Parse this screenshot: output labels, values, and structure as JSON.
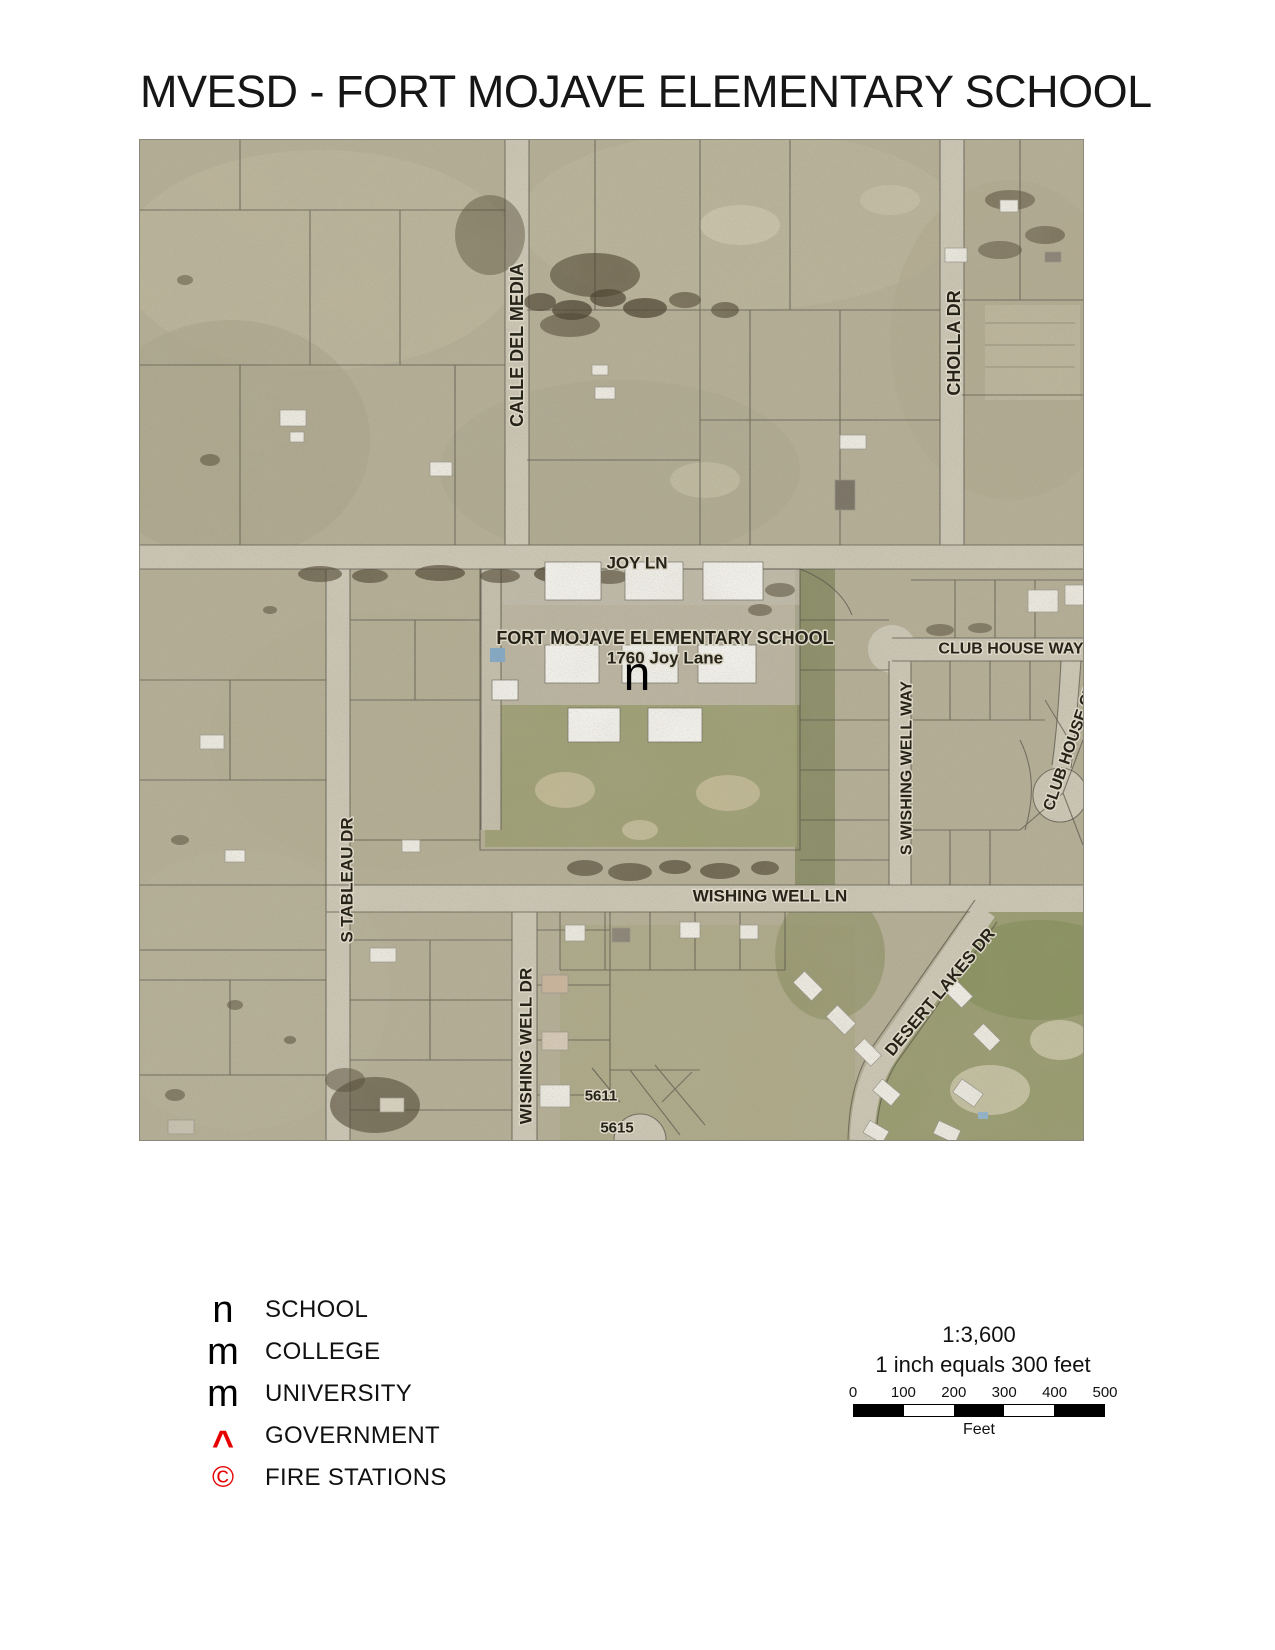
{
  "title": "MVESD - FORT MOJAVE ELEMENTARY SCHOOL",
  "map": {
    "school": {
      "name": "FORT MOJAVE ELEMENTARY SCHOOL",
      "address": "1760 Joy Lane",
      "marker": "n"
    },
    "streets": {
      "calle_del_media": "CALLE DEL MEDIA",
      "cholla_dr": "CHOLLA DR",
      "joy_ln": "JOY LN",
      "club_house_way": "CLUB HOUSE WAY",
      "s_wishing_well_way": "S WISHING WELL WAY",
      "club_house_ct": "CLUB HOUSE CT",
      "s_tableau_dr": "S TABLEAU DR",
      "wishing_well_ln": "WISHING WELL LN",
      "wishing_well_dr": "WISHING WELL DR",
      "desert_lakes_dr": "DESERT LAKES DR"
    },
    "parcel_numbers": [
      "5611",
      "5615"
    ]
  },
  "legend": {
    "items": [
      {
        "symbol": "n",
        "label": "SCHOOL",
        "color": "#000000"
      },
      {
        "symbol": "m",
        "label": "COLLEGE",
        "color": "#000000"
      },
      {
        "symbol": "m",
        "label": "UNIVERSITY",
        "color": "#000000"
      },
      {
        "symbol": "^",
        "label": "GOVERNMENT",
        "color": "#e60000"
      },
      {
        "symbol": "©",
        "label": "FIRE STATIONS",
        "color": "#e60000"
      }
    ]
  },
  "scale": {
    "ratio": "1:3,600",
    "caption": "1 inch equals 300 feet",
    "ticks": [
      "0",
      "100",
      "200",
      "300",
      "400",
      "500"
    ],
    "unit": "Feet"
  },
  "colors": {
    "aerial_base": "#b5ae96",
    "road": "#ccc7b6",
    "map_label": "#262319",
    "label_halo": "#dcd7c6",
    "legend_red": "#e60000"
  }
}
